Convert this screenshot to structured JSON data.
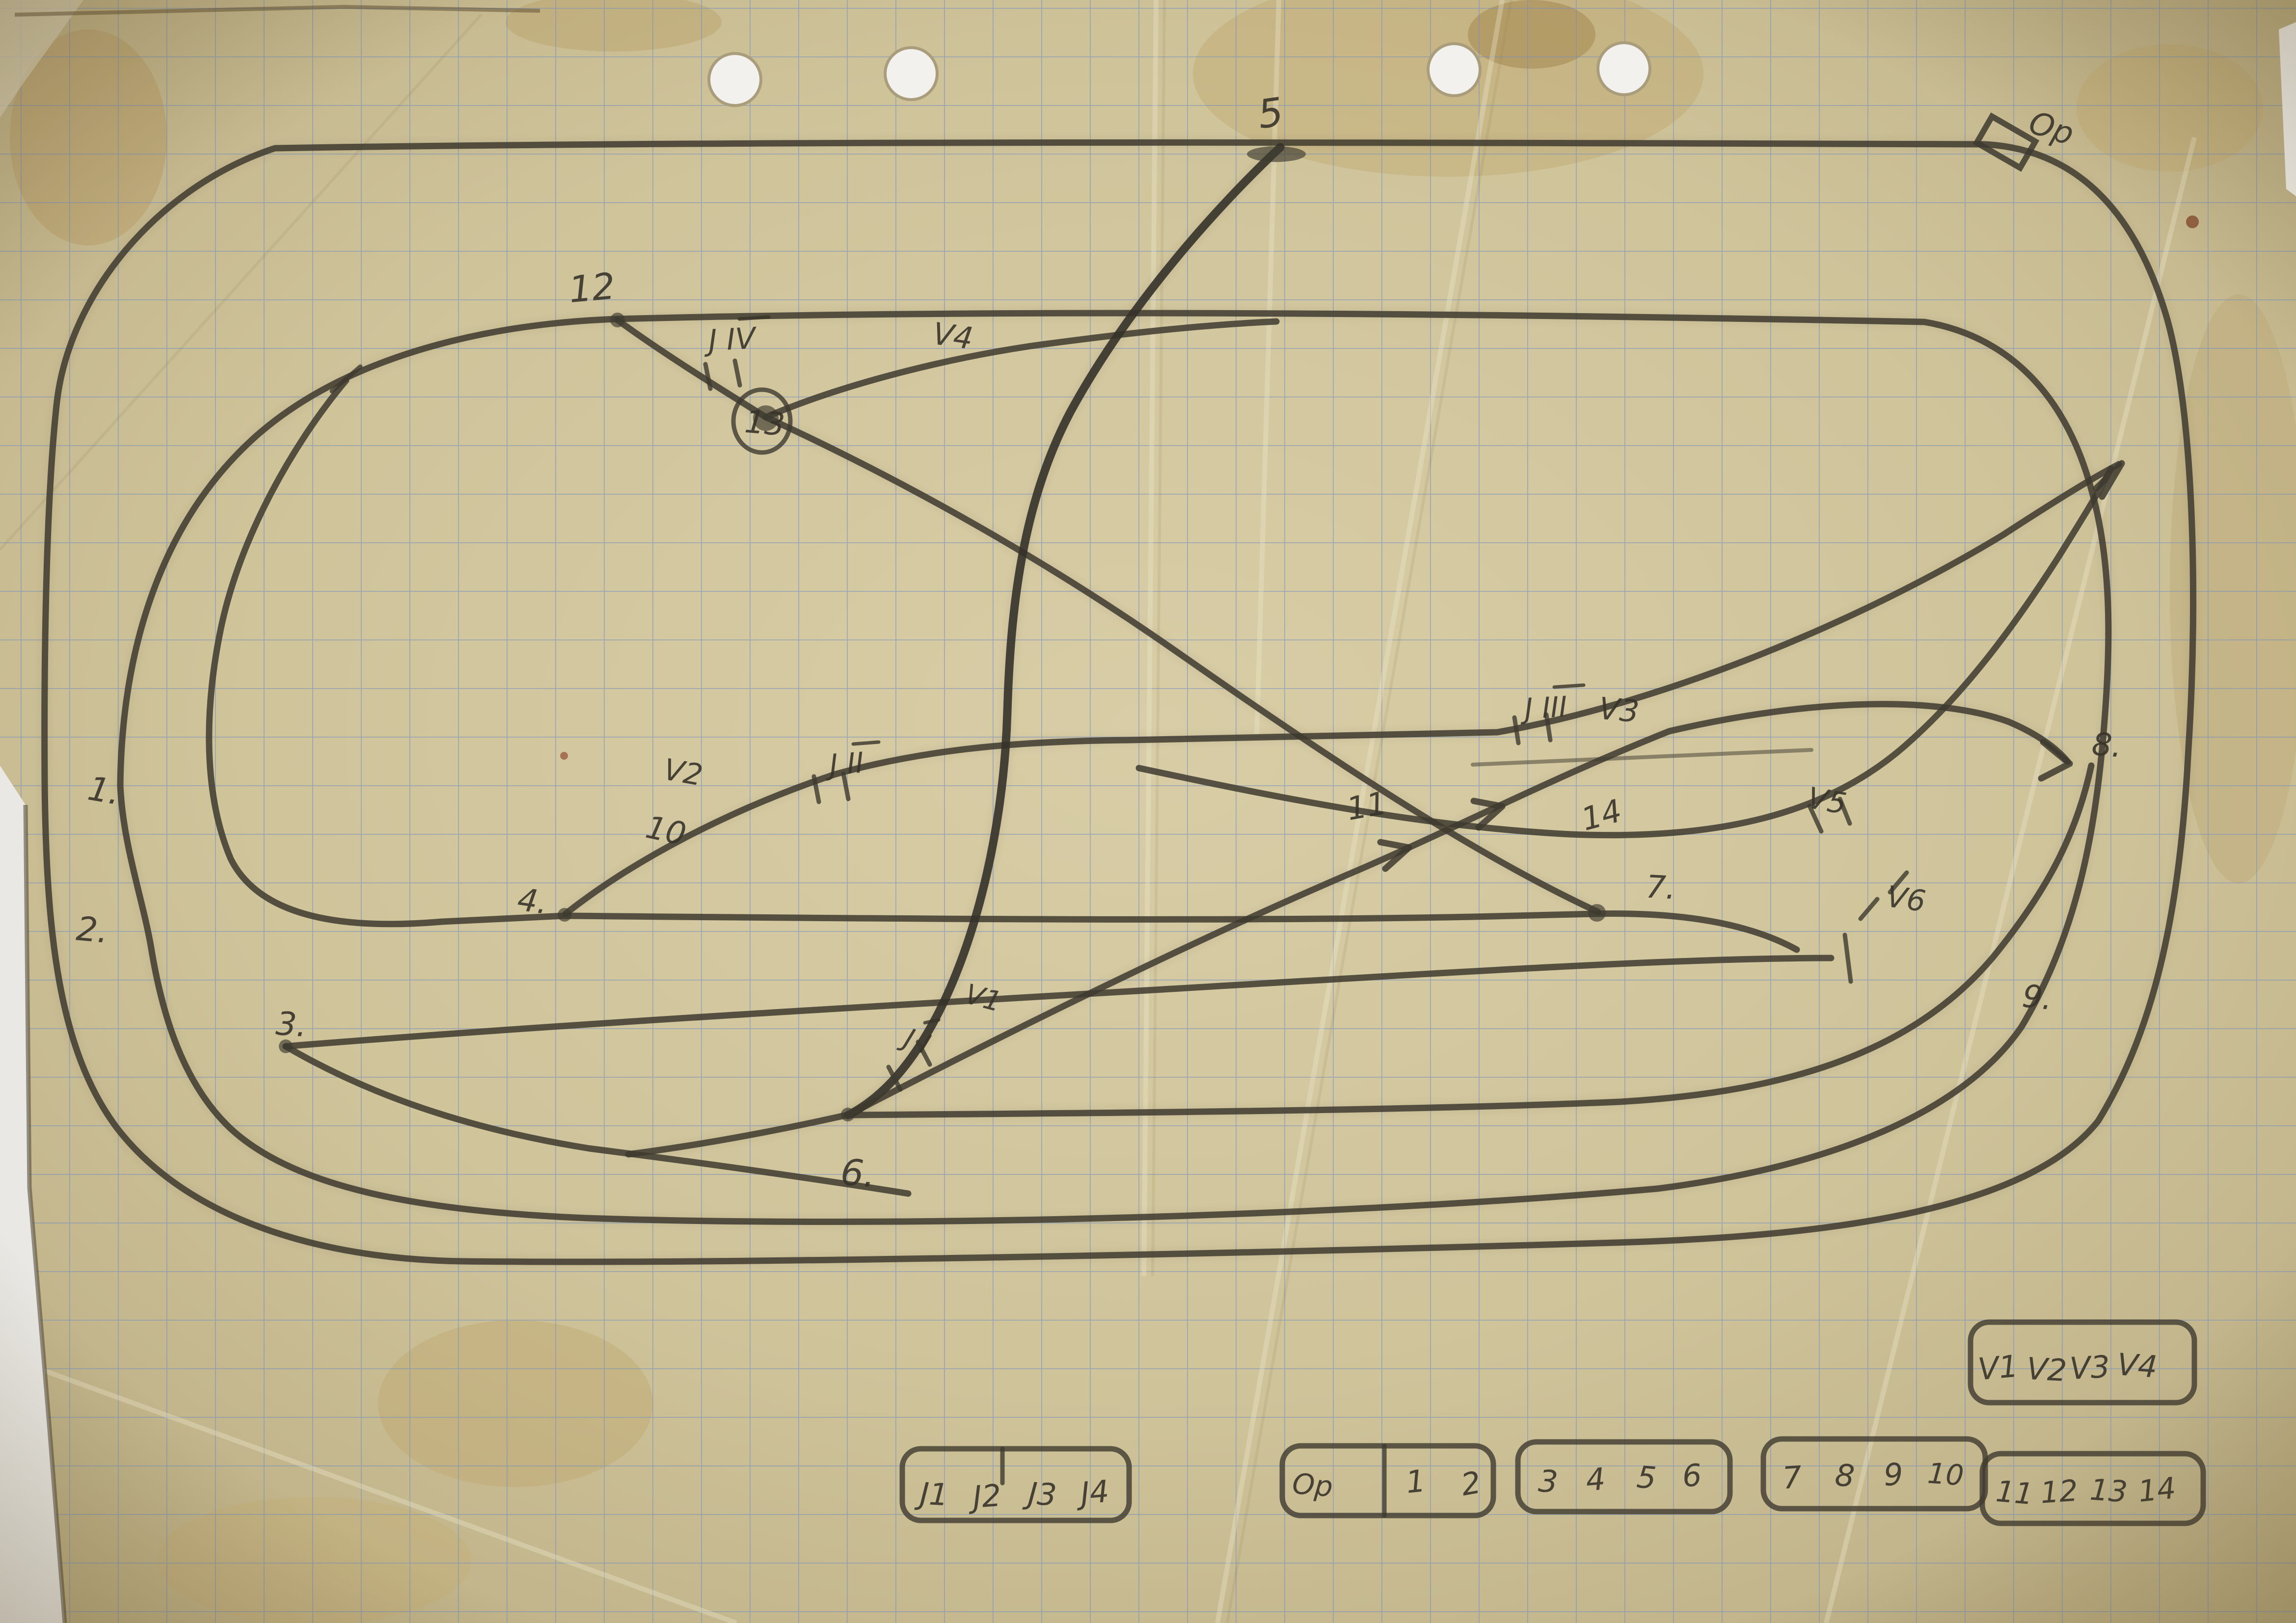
{
  "colors": {
    "paper": "#cfc49c",
    "paper_edge": "#b3a67c",
    "grid_blue": "#6f8cc0",
    "pencil": "#3e3a2f",
    "background": "#e9e8e4"
  },
  "plan_labels": {
    "point_1": "1.",
    "point_2": "2.",
    "point_3": "3.",
    "point_4": "4.",
    "point_5": "5",
    "point_6": "6.",
    "point_7": "7.",
    "point_8": "8.",
    "point_9": "9.",
    "track_10": "10",
    "track_11": "11",
    "track_12": "12",
    "track_13": "13",
    "track_14": "14",
    "signal_v1": "V1",
    "signal_v2": "V2",
    "signal_v3": "V3",
    "signal_v4": "V4",
    "signal_v5": "V5",
    "signal_v6": "V6",
    "junction_j1": "J I",
    "junction_j2": "J II",
    "junction_j3": "J III",
    "junction_j4": "J IV",
    "op": "Op"
  },
  "legend": {
    "v_box": {
      "items": [
        "V1",
        "V2",
        "V3",
        "V4"
      ]
    },
    "j_box": {
      "items": [
        "J1",
        "J2",
        "J3",
        "J4"
      ]
    },
    "op_box": {
      "label": "Op",
      "items": [
        "1",
        "2"
      ]
    },
    "box_3_6": {
      "items": [
        "3",
        "4",
        "5",
        "6"
      ]
    },
    "box_7_10": {
      "items": [
        "7",
        "8",
        "9",
        "10"
      ]
    },
    "box_11_14": {
      "items": [
        "11",
        "12",
        "13",
        "14"
      ]
    }
  }
}
